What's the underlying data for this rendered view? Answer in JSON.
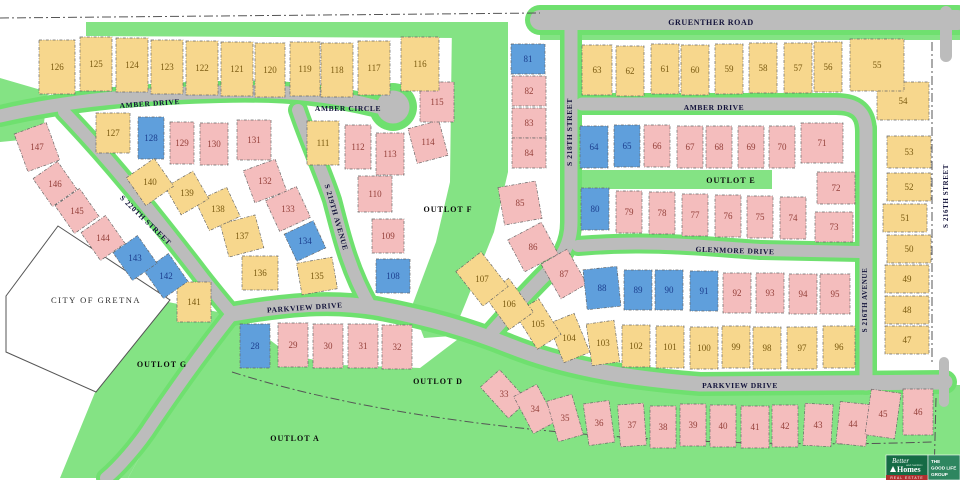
{
  "map": {
    "city_label": {
      "text": "CITY OF GRETNA",
      "x": 96,
      "y": 303
    },
    "street_labels": [
      {
        "id": "gruenther-road",
        "text": "GRUENTHER ROAD",
        "x": 711,
        "y": 25,
        "r": 0,
        "s": 8
      },
      {
        "id": "amber-drive-west",
        "text": "AMBER DRIVE",
        "x": 150,
        "y": 106,
        "r": -4,
        "s": 7.5
      },
      {
        "id": "amber-circle",
        "text": "AMBER CIRCLE",
        "x": 348,
        "y": 111,
        "r": 0,
        "s": 7.5
      },
      {
        "id": "amber-drive-east",
        "text": "AMBER DRIVE",
        "x": 714,
        "y": 110,
        "r": 0,
        "s": 7.5
      },
      {
        "id": "s-220th-street",
        "text": "S 220TH STREET",
        "x": 144,
        "y": 222,
        "r": 44,
        "s": 7.5
      },
      {
        "id": "s-219th-avenue",
        "text": "S 219TH AVENUE",
        "x": 334,
        "y": 218,
        "r": 74,
        "s": 7.5
      },
      {
        "id": "s-218th-street",
        "text": "S 218TH STREET",
        "x": 572,
        "y": 132,
        "r": -90,
        "s": 7.5
      },
      {
        "id": "glenmore-drive",
        "text": "GLENMORE DRIVE",
        "x": 735,
        "y": 253,
        "r": 2,
        "s": 7.5
      },
      {
        "id": "s-216th-avenue",
        "text": "S 216TH AVENUE",
        "x": 867,
        "y": 300,
        "r": -90,
        "s": 7
      },
      {
        "id": "s-216th-street",
        "text": "S 216TH STREET",
        "x": 948,
        "y": 196,
        "r": -90,
        "s": 7
      },
      {
        "id": "parkview-drive-west",
        "text": "PARKVIEW DRIVE",
        "x": 305,
        "y": 310,
        "r": -4,
        "s": 7.5
      },
      {
        "id": "parkview-drive-east",
        "text": "PARKVIEW DRIVE",
        "x": 740,
        "y": 388,
        "r": 0,
        "s": 7.5
      }
    ],
    "outlot_labels": [
      {
        "id": "outlot-a",
        "text": "OUTLOT A",
        "x": 295,
        "y": 441
      },
      {
        "id": "outlot-d",
        "text": "OUTLOT D",
        "x": 438,
        "y": 384
      },
      {
        "id": "outlot-e",
        "text": "OUTLOT E",
        "x": 731,
        "y": 183
      },
      {
        "id": "outlot-f",
        "text": "OUTLOT F",
        "x": 448,
        "y": 212
      },
      {
        "id": "outlot-g",
        "text": "OUTLOT G",
        "x": 162,
        "y": 367
      }
    ],
    "colors": {
      "lot_yellow": "#f7d78d",
      "lot_pink": "#f4bdbd",
      "lot_blue": "#5f9fdc",
      "green": "#84e384",
      "road": "#bcbcbc",
      "num_yellow": "#7a5a10",
      "num_pink": "#94403a",
      "num_blue": "#1c3e8e"
    },
    "lots": [
      {
        "n": 28,
        "x": 255,
        "y": 346,
        "w": 30,
        "h": 44,
        "c": "b"
      },
      {
        "n": 29,
        "x": 293,
        "y": 345,
        "w": 30,
        "h": 44,
        "c": "p"
      },
      {
        "n": 30,
        "x": 328,
        "y": 346,
        "w": 30,
        "h": 44,
        "c": "p"
      },
      {
        "n": 31,
        "x": 363,
        "y": 346,
        "w": 30,
        "h": 44,
        "c": "p"
      },
      {
        "n": 32,
        "x": 397,
        "y": 347,
        "w": 30,
        "h": 44,
        "c": "p"
      },
      {
        "n": 33,
        "x": 504,
        "y": 394,
        "w": 26,
        "h": 42,
        "c": "p",
        "r": -42
      },
      {
        "n": 34,
        "x": 535,
        "y": 409,
        "w": 26,
        "h": 42,
        "c": "p",
        "r": -28
      },
      {
        "n": 35,
        "x": 565,
        "y": 418,
        "w": 26,
        "h": 42,
        "c": "p",
        "r": -16
      },
      {
        "n": 36,
        "x": 599,
        "y": 423,
        "w": 26,
        "h": 42,
        "c": "p",
        "r": -8
      },
      {
        "n": 37,
        "x": 632,
        "y": 425,
        "w": 26,
        "h": 42,
        "c": "p",
        "r": -4
      },
      {
        "n": 38,
        "x": 663,
        "y": 427,
        "w": 26,
        "h": 42,
        "c": "p"
      },
      {
        "n": 39,
        "x": 693,
        "y": 425,
        "w": 26,
        "h": 42,
        "c": "p"
      },
      {
        "n": 40,
        "x": 723,
        "y": 426,
        "w": 26,
        "h": 42,
        "c": "p"
      },
      {
        "n": 41,
        "x": 755,
        "y": 427,
        "w": 28,
        "h": 42,
        "c": "p"
      },
      {
        "n": 42,
        "x": 785,
        "y": 426,
        "w": 26,
        "h": 42,
        "c": "p"
      },
      {
        "n": 43,
        "x": 818,
        "y": 425,
        "w": 28,
        "h": 42,
        "c": "p",
        "r": 3
      },
      {
        "n": 44,
        "x": 853,
        "y": 424,
        "w": 30,
        "h": 42,
        "c": "p",
        "r": 6
      },
      {
        "n": 45,
        "x": 883,
        "y": 414,
        "w": 30,
        "h": 46,
        "c": "p",
        "r": 8
      },
      {
        "n": 46,
        "x": 918,
        "y": 412,
        "w": 30,
        "h": 46,
        "c": "p"
      },
      {
        "n": 47,
        "x": 907,
        "y": 340,
        "w": 44,
        "h": 28,
        "c": "y"
      },
      {
        "n": 48,
        "x": 907,
        "y": 310,
        "w": 44,
        "h": 28,
        "c": "y"
      },
      {
        "n": 49,
        "x": 907,
        "y": 279,
        "w": 44,
        "h": 28,
        "c": "y"
      },
      {
        "n": 50,
        "x": 909,
        "y": 249,
        "w": 44,
        "h": 28,
        "c": "y"
      },
      {
        "n": 51,
        "x": 905,
        "y": 218,
        "w": 44,
        "h": 28,
        "c": "y"
      },
      {
        "n": 52,
        "x": 909,
        "y": 187,
        "w": 44,
        "h": 28,
        "c": "y"
      },
      {
        "n": 53,
        "x": 909,
        "y": 152,
        "w": 44,
        "h": 32,
        "c": "y"
      },
      {
        "n": 54,
        "x": 903,
        "y": 101,
        "w": 52,
        "h": 38,
        "c": "y"
      },
      {
        "n": 55,
        "x": 877,
        "y": 65,
        "w": 54,
        "h": 52,
        "c": "y"
      },
      {
        "n": 56,
        "x": 828,
        "y": 67,
        "w": 28,
        "h": 50,
        "c": "y"
      },
      {
        "n": 57,
        "x": 798,
        "y": 68,
        "w": 28,
        "h": 50,
        "c": "y"
      },
      {
        "n": 58,
        "x": 763,
        "y": 68,
        "w": 28,
        "h": 50,
        "c": "y"
      },
      {
        "n": 59,
        "x": 729,
        "y": 69,
        "w": 28,
        "h": 50,
        "c": "y"
      },
      {
        "n": 60,
        "x": 695,
        "y": 70,
        "w": 28,
        "h": 50,
        "c": "y"
      },
      {
        "n": 61,
        "x": 665,
        "y": 69,
        "w": 28,
        "h": 50,
        "c": "y"
      },
      {
        "n": 62,
        "x": 630,
        "y": 71,
        "w": 28,
        "h": 50,
        "c": "y"
      },
      {
        "n": 63,
        "x": 597,
        "y": 70,
        "w": 30,
        "h": 50,
        "c": "y"
      },
      {
        "n": 64,
        "x": 594,
        "y": 147,
        "w": 28,
        "h": 42,
        "c": "b"
      },
      {
        "n": 65,
        "x": 627,
        "y": 146,
        "w": 26,
        "h": 42,
        "c": "b"
      },
      {
        "n": 66,
        "x": 657,
        "y": 146,
        "w": 26,
        "h": 42,
        "c": "p"
      },
      {
        "n": 67,
        "x": 690,
        "y": 147,
        "w": 26,
        "h": 42,
        "c": "p"
      },
      {
        "n": 68,
        "x": 719,
        "y": 147,
        "w": 26,
        "h": 42,
        "c": "p"
      },
      {
        "n": 69,
        "x": 751,
        "y": 147,
        "w": 26,
        "h": 42,
        "c": "p"
      },
      {
        "n": 70,
        "x": 782,
        "y": 147,
        "w": 26,
        "h": 42,
        "c": "p"
      },
      {
        "n": 71,
        "x": 822,
        "y": 143,
        "w": 42,
        "h": 40,
        "c": "p"
      },
      {
        "n": 72,
        "x": 836,
        "y": 188,
        "w": 38,
        "h": 32,
        "c": "p"
      },
      {
        "n": 73,
        "x": 834,
        "y": 227,
        "w": 38,
        "h": 30,
        "c": "p"
      },
      {
        "n": 74,
        "x": 793,
        "y": 218,
        "w": 26,
        "h": 42,
        "c": "p"
      },
      {
        "n": 75,
        "x": 760,
        "y": 217,
        "w": 26,
        "h": 42,
        "c": "p"
      },
      {
        "n": 76,
        "x": 728,
        "y": 216,
        "w": 26,
        "h": 42,
        "c": "p"
      },
      {
        "n": 77,
        "x": 695,
        "y": 215,
        "w": 26,
        "h": 42,
        "c": "p"
      },
      {
        "n": 78,
        "x": 662,
        "y": 213,
        "w": 26,
        "h": 42,
        "c": "p"
      },
      {
        "n": 79,
        "x": 629,
        "y": 212,
        "w": 26,
        "h": 42,
        "c": "p"
      },
      {
        "n": 80,
        "x": 595,
        "y": 209,
        "w": 28,
        "h": 42,
        "c": "b"
      },
      {
        "n": 81,
        "x": 528,
        "y": 59,
        "w": 34,
        "h": 30,
        "c": "b"
      },
      {
        "n": 82,
        "x": 529,
        "y": 91,
        "w": 34,
        "h": 30,
        "c": "p"
      },
      {
        "n": 83,
        "x": 529,
        "y": 123,
        "w": 34,
        "h": 30,
        "c": "p"
      },
      {
        "n": 84,
        "x": 529,
        "y": 153,
        "w": 34,
        "h": 30,
        "c": "p"
      },
      {
        "n": 85,
        "x": 520,
        "y": 203,
        "w": 38,
        "h": 38,
        "c": "p",
        "r": -10
      },
      {
        "n": 86,
        "x": 533,
        "y": 247,
        "w": 38,
        "h": 36,
        "c": "p",
        "r": -28
      },
      {
        "n": 87,
        "x": 564,
        "y": 274,
        "w": 30,
        "h": 40,
        "c": "p",
        "r": -30
      },
      {
        "n": 88,
        "x": 602,
        "y": 288,
        "w": 34,
        "h": 40,
        "c": "b",
        "r": -6
      },
      {
        "n": 89,
        "x": 638,
        "y": 290,
        "w": 28,
        "h": 40,
        "c": "b"
      },
      {
        "n": 90,
        "x": 669,
        "y": 290,
        "w": 28,
        "h": 40,
        "c": "b"
      },
      {
        "n": 91,
        "x": 704,
        "y": 291,
        "w": 28,
        "h": 40,
        "c": "b"
      },
      {
        "n": 92,
        "x": 737,
        "y": 293,
        "w": 28,
        "h": 40,
        "c": "p"
      },
      {
        "n": 93,
        "x": 770,
        "y": 293,
        "w": 28,
        "h": 40,
        "c": "p"
      },
      {
        "n": 94,
        "x": 803,
        "y": 294,
        "w": 28,
        "h": 40,
        "c": "p"
      },
      {
        "n": 95,
        "x": 835,
        "y": 294,
        "w": 30,
        "h": 40,
        "c": "p"
      },
      {
        "n": 96,
        "x": 839,
        "y": 347,
        "w": 32,
        "h": 42,
        "c": "y"
      },
      {
        "n": 97,
        "x": 802,
        "y": 348,
        "w": 30,
        "h": 42,
        "c": "y"
      },
      {
        "n": 98,
        "x": 767,
        "y": 348,
        "w": 28,
        "h": 42,
        "c": "y"
      },
      {
        "n": 99,
        "x": 736,
        "y": 347,
        "w": 28,
        "h": 42,
        "c": "y"
      },
      {
        "n": 100,
        "x": 704,
        "y": 348,
        "w": 28,
        "h": 42,
        "c": "y"
      },
      {
        "n": 101,
        "x": 670,
        "y": 347,
        "w": 28,
        "h": 42,
        "c": "y"
      },
      {
        "n": 102,
        "x": 636,
        "y": 346,
        "w": 28,
        "h": 42,
        "c": "y"
      },
      {
        "n": 103,
        "x": 603,
        "y": 343,
        "w": 28,
        "h": 42,
        "c": "y",
        "r": -8
      },
      {
        "n": 104,
        "x": 569,
        "y": 338,
        "w": 28,
        "h": 42,
        "c": "y",
        "r": -22
      },
      {
        "n": 105,
        "x": 538,
        "y": 324,
        "w": 28,
        "h": 42,
        "c": "y",
        "r": -32
      },
      {
        "n": 106,
        "x": 509,
        "y": 304,
        "w": 30,
        "h": 42,
        "c": "y",
        "r": -36
      },
      {
        "n": 107,
        "x": 482,
        "y": 279,
        "w": 32,
        "h": 44,
        "c": "y",
        "r": -38
      },
      {
        "n": 108,
        "x": 393,
        "y": 276,
        "w": 34,
        "h": 34,
        "c": "b"
      },
      {
        "n": 109,
        "x": 388,
        "y": 236,
        "w": 32,
        "h": 34,
        "c": "p"
      },
      {
        "n": 110,
        "x": 375,
        "y": 194,
        "w": 34,
        "h": 36,
        "c": "p"
      },
      {
        "n": 111,
        "x": 323,
        "y": 143,
        "w": 32,
        "h": 44,
        "c": "y"
      },
      {
        "n": 112,
        "x": 358,
        "y": 147,
        "w": 26,
        "h": 44,
        "c": "p"
      },
      {
        "n": 113,
        "x": 390,
        "y": 154,
        "w": 28,
        "h": 42,
        "c": "p"
      },
      {
        "n": 114,
        "x": 428,
        "y": 142,
        "w": 32,
        "h": 36,
        "c": "p",
        "r": -15
      },
      {
        "n": 115,
        "x": 437,
        "y": 102,
        "w": 34,
        "h": 40,
        "c": "p"
      },
      {
        "n": 116,
        "x": 420,
        "y": 64,
        "w": 38,
        "h": 54,
        "c": "y"
      },
      {
        "n": 117,
        "x": 374,
        "y": 68,
        "w": 32,
        "h": 54,
        "c": "y"
      },
      {
        "n": 118,
        "x": 337,
        "y": 70,
        "w": 32,
        "h": 54,
        "c": "y"
      },
      {
        "n": 119,
        "x": 305,
        "y": 69,
        "w": 30,
        "h": 54,
        "c": "y"
      },
      {
        "n": 120,
        "x": 270,
        "y": 70,
        "w": 30,
        "h": 54,
        "c": "y"
      },
      {
        "n": 121,
        "x": 237,
        "y": 69,
        "w": 32,
        "h": 54,
        "c": "y"
      },
      {
        "n": 122,
        "x": 202,
        "y": 68,
        "w": 32,
        "h": 54,
        "c": "y"
      },
      {
        "n": 123,
        "x": 167,
        "y": 67,
        "w": 32,
        "h": 54,
        "c": "y"
      },
      {
        "n": 124,
        "x": 132,
        "y": 65,
        "w": 32,
        "h": 54,
        "c": "y"
      },
      {
        "n": 125,
        "x": 96,
        "y": 64,
        "w": 32,
        "h": 54,
        "c": "y"
      },
      {
        "n": 126,
        "x": 57,
        "y": 67,
        "w": 36,
        "h": 54,
        "c": "y"
      },
      {
        "n": 127,
        "x": 113,
        "y": 133,
        "w": 34,
        "h": 40,
        "c": "y"
      },
      {
        "n": 128,
        "x": 151,
        "y": 138,
        "w": 26,
        "h": 42,
        "c": "b"
      },
      {
        "n": 129,
        "x": 182,
        "y": 143,
        "w": 24,
        "h": 42,
        "c": "p"
      },
      {
        "n": 130,
        "x": 214,
        "y": 144,
        "w": 28,
        "h": 42,
        "c": "p"
      },
      {
        "n": 131,
        "x": 254,
        "y": 140,
        "w": 34,
        "h": 40,
        "c": "p"
      },
      {
        "n": 132,
        "x": 265,
        "y": 181,
        "w": 34,
        "h": 34,
        "c": "p",
        "r": -20
      },
      {
        "n": 133,
        "x": 288,
        "y": 209,
        "w": 34,
        "h": 34,
        "c": "p",
        "r": -25
      },
      {
        "n": 134,
        "x": 305,
        "y": 241,
        "w": 32,
        "h": 30,
        "c": "b",
        "r": -25
      },
      {
        "n": 135,
        "x": 317,
        "y": 276,
        "w": 36,
        "h": 32,
        "c": "y",
        "r": -10
      },
      {
        "n": 136,
        "x": 260,
        "y": 273,
        "w": 36,
        "h": 34,
        "c": "y"
      },
      {
        "n": 137,
        "x": 242,
        "y": 236,
        "w": 36,
        "h": 34,
        "c": "y",
        "r": -15
      },
      {
        "n": 138,
        "x": 218,
        "y": 209,
        "w": 34,
        "h": 32,
        "c": "y",
        "r": -25
      },
      {
        "n": 139,
        "x": 187,
        "y": 193,
        "w": 32,
        "h": 32,
        "c": "y",
        "r": -30
      },
      {
        "n": 140,
        "x": 150,
        "y": 182,
        "w": 34,
        "h": 34,
        "c": "y",
        "r": -35
      },
      {
        "n": 141,
        "x": 194,
        "y": 302,
        "w": 34,
        "h": 40,
        "c": "y"
      },
      {
        "n": 142,
        "x": 166,
        "y": 276,
        "w": 30,
        "h": 34,
        "c": "b",
        "r": -35
      },
      {
        "n": 143,
        "x": 135,
        "y": 258,
        "w": 30,
        "h": 34,
        "c": "b",
        "r": -35
      },
      {
        "n": 144,
        "x": 103,
        "y": 238,
        "w": 30,
        "h": 34,
        "c": "p",
        "r": -35
      },
      {
        "n": 145,
        "x": 77,
        "y": 211,
        "w": 30,
        "h": 34,
        "c": "p",
        "r": -35
      },
      {
        "n": 146,
        "x": 55,
        "y": 184,
        "w": 30,
        "h": 34,
        "c": "p",
        "r": -35
      },
      {
        "n": 147,
        "x": 37,
        "y": 147,
        "w": 34,
        "h": 40,
        "c": "p",
        "r": -20
      }
    ]
  },
  "logo": {
    "brand_line1": "Better",
    "brand_line2": "Homes",
    "brand_line3": "and Gardens",
    "brand_line4": "REAL ESTATE",
    "tagline1": "THE",
    "tagline2": "GOOD LIFE",
    "tagline3": "GROUP",
    "green_dark": "#156b45",
    "green_mid": "#2e8660",
    "red": "#b03030"
  }
}
